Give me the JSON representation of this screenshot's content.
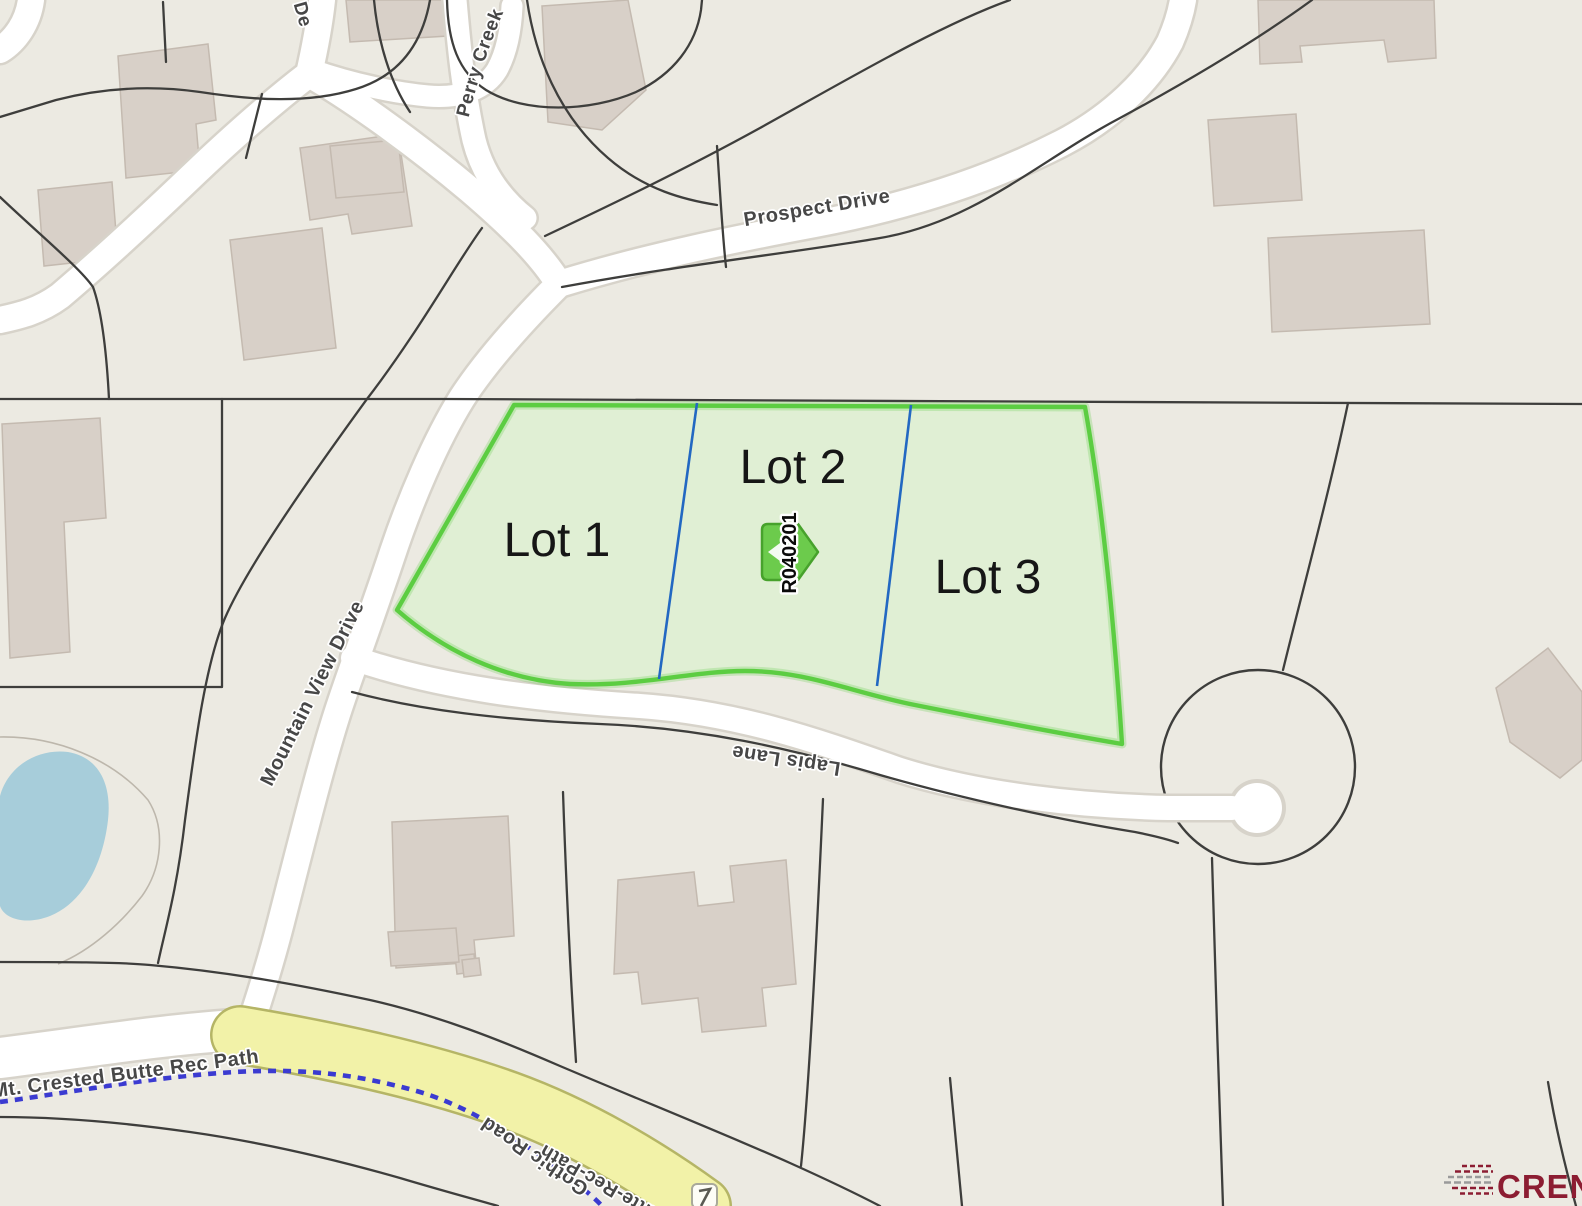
{
  "map": {
    "background_color": "#ECEAE2",
    "streets": {
      "de": {
        "label": "De"
      },
      "perry_creek": {
        "label": "Perry Creek S"
      },
      "prospect": {
        "label": "Prospect Drive"
      },
      "mountain_view": {
        "label": "Mountain View Drive"
      },
      "lapis": {
        "label": "Lapis Lane"
      },
      "gothic": {
        "label": "Gothic Road"
      },
      "rec_path": {
        "label": "Mt. Crested Butte Rec Path"
      },
      "rec_path_partial": {
        "label": "Butte-Rec-Path"
      }
    },
    "highlighted_parcel": {
      "lots": [
        {
          "label": "Lot 1"
        },
        {
          "label": "Lot 2"
        },
        {
          "label": "Lot 3"
        }
      ],
      "marker_id": "R040201",
      "fill_color": "#DFEED3",
      "border_color": "#5CCD42",
      "divider_color": "#2268C2"
    },
    "features": {
      "road_fill_color": "#FFFFFF",
      "road_casing_color": "#D7D3CA",
      "parcel_line_color": "#3E3E3C",
      "building_color": "#D8D0C8",
      "pond_color": "#A7CDDA",
      "gothic_road_color": "#F2F2A8",
      "gothic_road_edge_color": "#B5B566",
      "rec_path_dash_color": "#3B3BD1",
      "shield_icon": "route-shield"
    },
    "watermark": {
      "text": "CREN",
      "color": "#8C1D32"
    }
  }
}
